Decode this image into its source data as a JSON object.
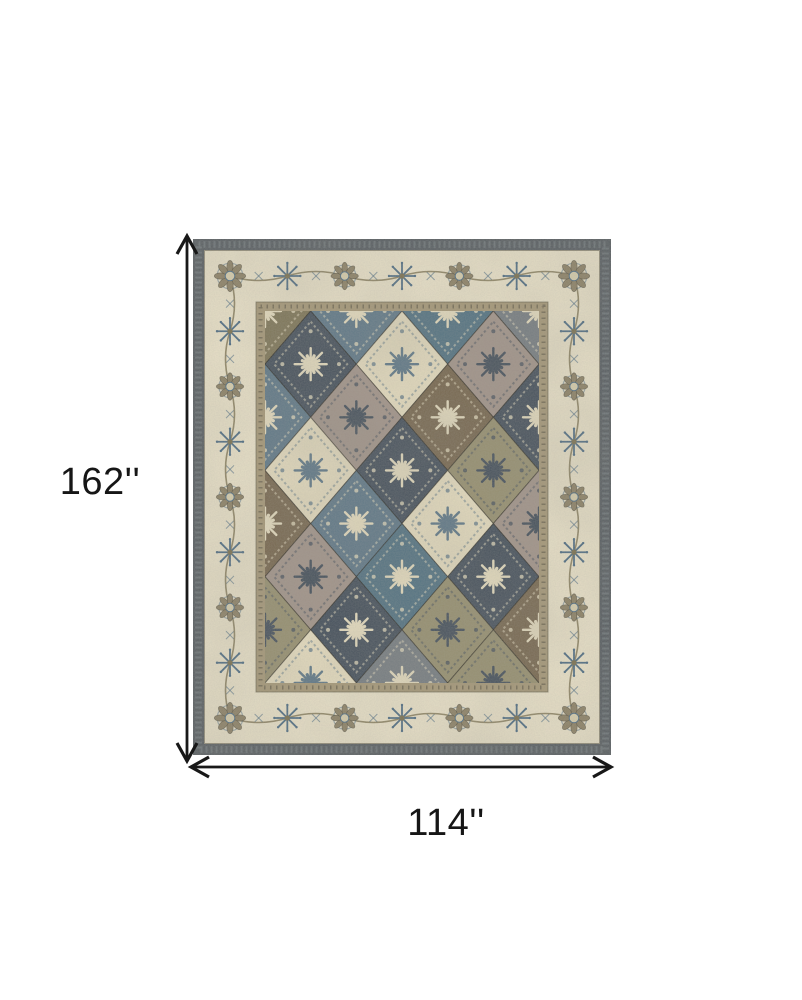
{
  "diagram": {
    "kind": "product-dimensions",
    "subject": "Traditional panel-patterned area rug in blue, taupe, brown and ivory",
    "background": "#ffffff"
  },
  "dimensions": {
    "height_label": "162''",
    "width_label": "114''",
    "height_inches": 162,
    "width_inches": 114,
    "unit": "inches",
    "arrow_color": "#181818"
  },
  "rug": {
    "x": 193,
    "y": 239,
    "width": 418,
    "height": 516,
    "layout": {
      "band": 11,
      "border_in": 63,
      "field_in": 72
    },
    "palette": {
      "edge": "#575d62",
      "edge_fleck": "#868e93",
      "ivory": "#e9e1c8",
      "frame": "#a69878",
      "frame_dark": "#6e6651",
      "field_base": "#8a8063",
      "navy": "#45505c",
      "cream": "#e5dcbf",
      "brown": "#77674f",
      "mauve": "#a2948a",
      "slate": "#5f7888",
      "teal": "#527283",
      "khaki": "#979070",
      "gray": "#767d82",
      "olive": "#7e7557",
      "motif_blue": "#4f6d84",
      "motif_taupe": "#8d8266",
      "motif_vine": "#7b7150",
      "motif_cream": "#d8cfae"
    },
    "accent_for": {
      "navy": "cream",
      "cream": "slate",
      "brown": "cream",
      "mauve": "navy",
      "slate": "cream",
      "teal": "cream",
      "khaki": "navy",
      "gray": "cream",
      "olive": "cream"
    },
    "panel_rows": [
      [
        "olive",
        "slate",
        "teal",
        "gray"
      ],
      [
        "navy",
        "cream",
        "mauve"
      ],
      [
        "slate",
        "mauve",
        "brown",
        "navy"
      ],
      [
        "cream",
        "navy",
        "khaki"
      ],
      [
        "brown",
        "slate",
        "cream",
        "mauve"
      ],
      [
        "mauve",
        "teal",
        "navy"
      ],
      [
        "khaki",
        "navy",
        "khaki",
        "brown"
      ],
      [
        "cream",
        "gray",
        "khaki"
      ]
    ]
  }
}
